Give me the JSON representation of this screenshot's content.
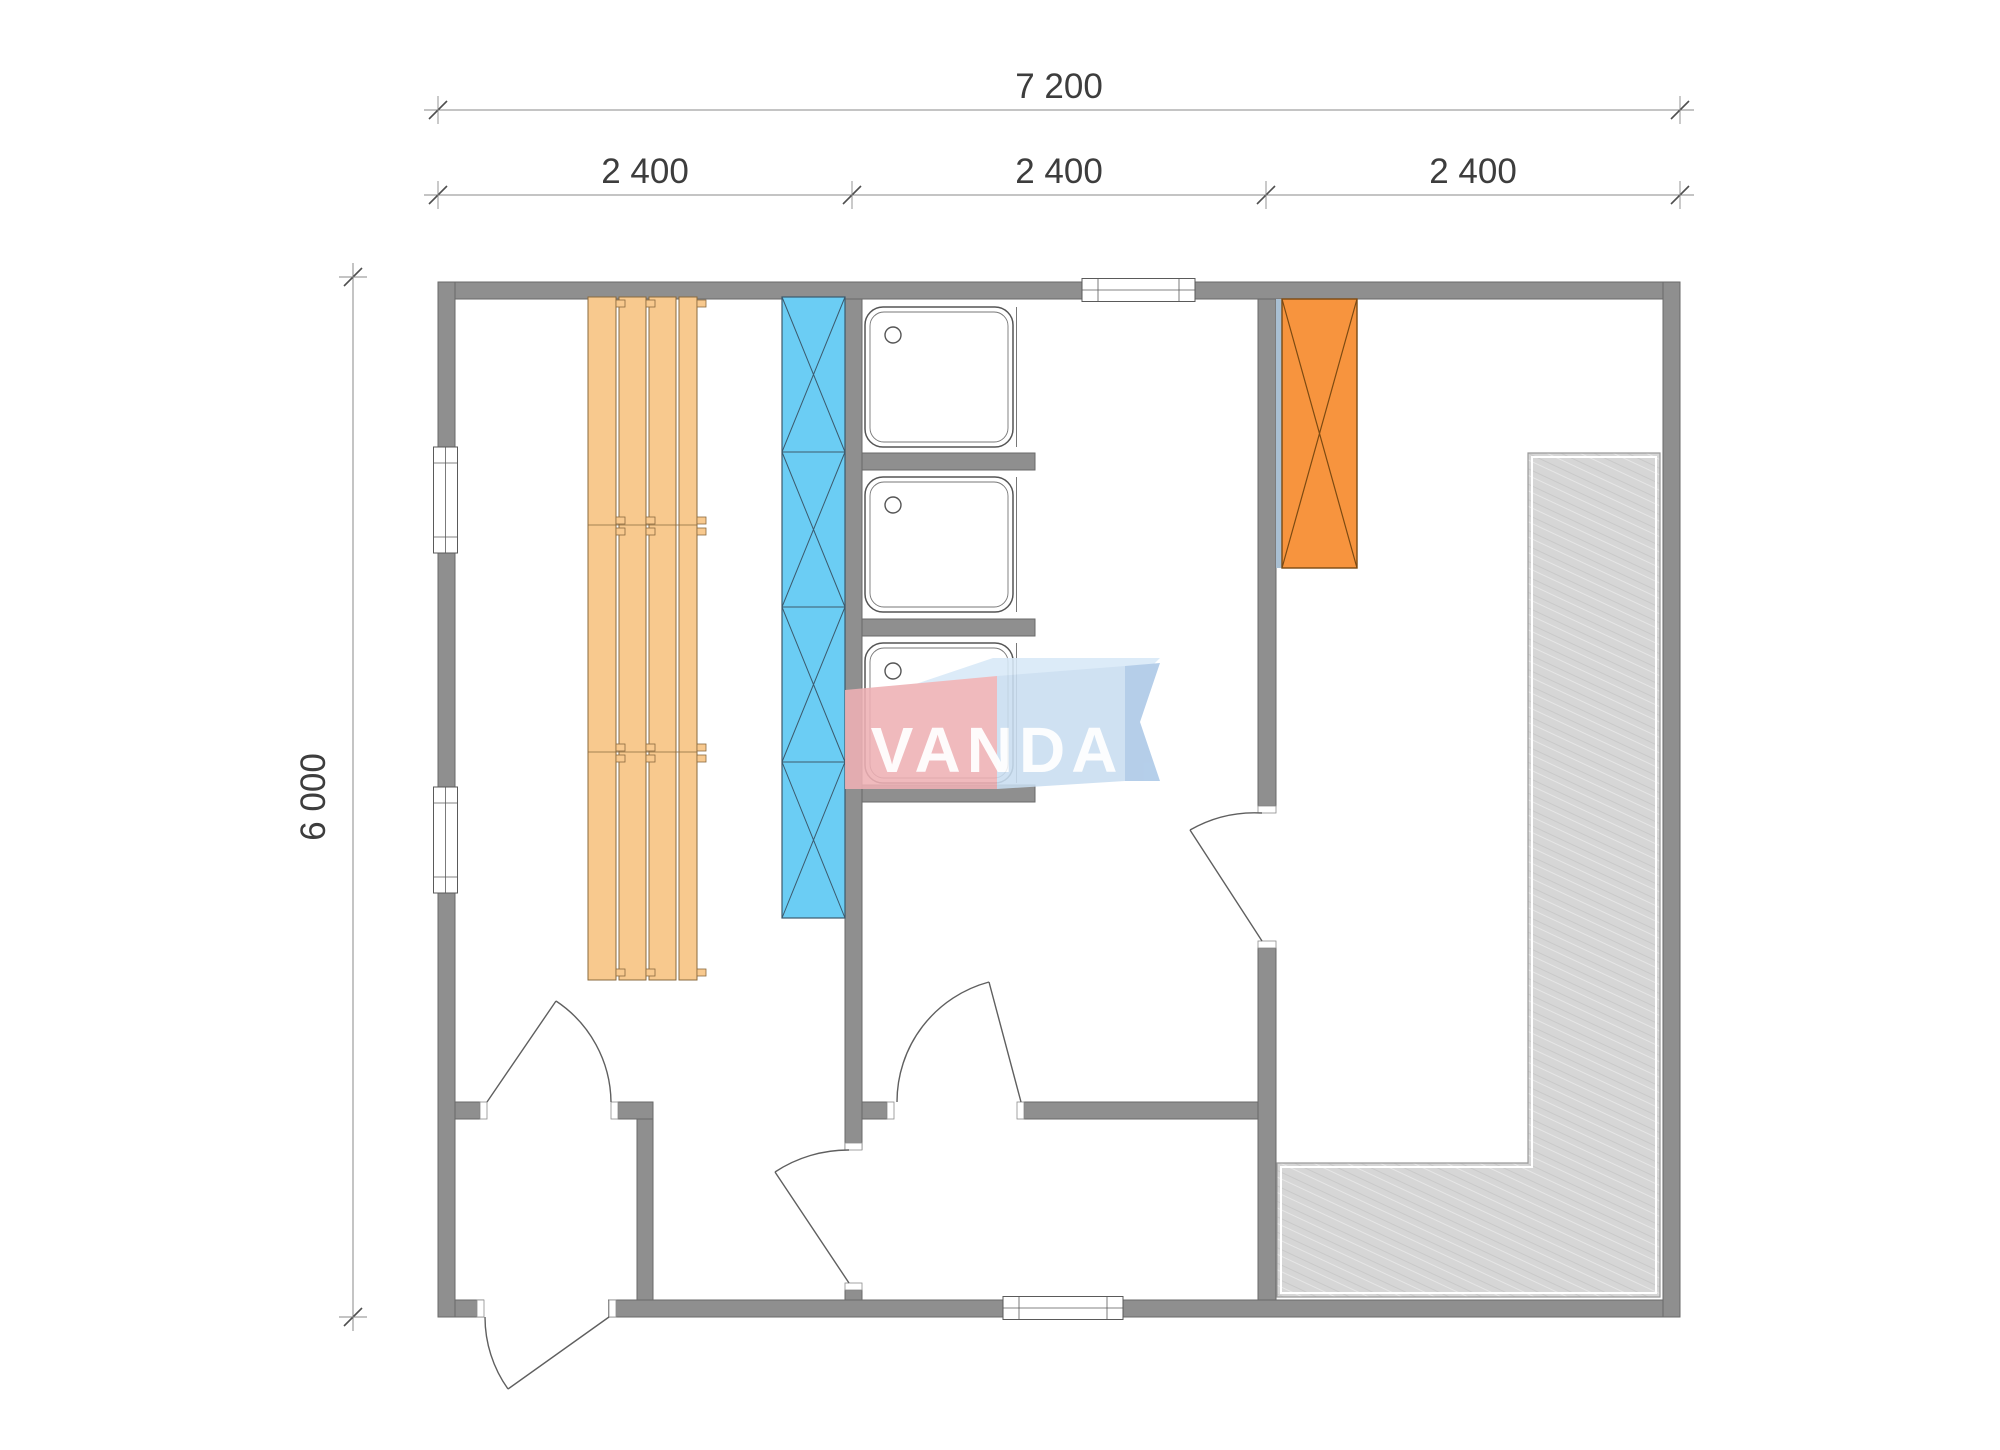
{
  "dimensions": {
    "total_width": "7 200",
    "modules": [
      "2 400",
      "2 400",
      "2 400"
    ],
    "height": "6 000"
  },
  "logo": {
    "text": "VANDA"
  },
  "elements": {
    "benches": "sauna bench planks",
    "blue_panel": "blue cross-hatched panel",
    "stove": "orange cross-hatched stove",
    "showers": "3 shower trays",
    "deck": "L-shaped hatched decking"
  },
  "colors": {
    "wall": "#8f8f8f",
    "wall-edge": "#6a6a6a",
    "bench": "#f8c98e",
    "bench-edge": "#8a6a3e",
    "panel-blue": "#6bcdf4",
    "panel-blue-edge": "#3c5a6d",
    "stove": "#f7943e",
    "stove-edge": "#7c4a12",
    "shield": "#a9bfd2",
    "deck": "#d6d6d6",
    "deck-edge": "#9b9b9b",
    "line": "#5f5f5f",
    "dim-line": "#8a8a8a",
    "dim-text": "#3d3d3d",
    "logo-red": "#efb1b5",
    "logo-blue": "#c9def1",
    "logo-blue-light": "#d8e9f8",
    "logo-blue-dark": "#abc8e7",
    "logo-text": "#ffffff"
  }
}
